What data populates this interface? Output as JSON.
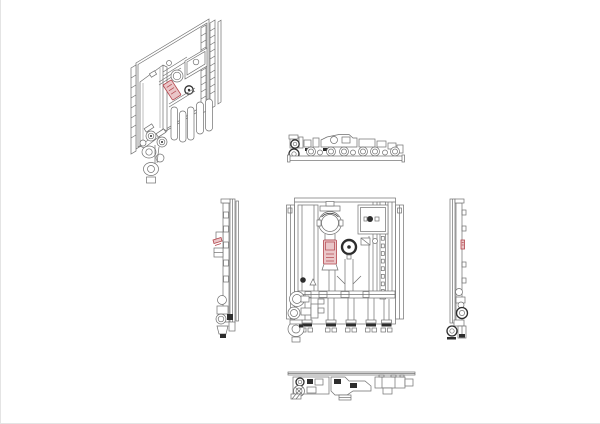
{
  "page": {
    "background": "#ffffff",
    "edge_line_color": "#e4e4e4"
  },
  "drawing": {
    "type": "cad-multiview-orthographic",
    "subject": "wall-mounted-hydraulic-module",
    "colors": {
      "line": "#6f6f6f",
      "line_dark": "#2d2d2d",
      "accent_stroke": "#b2444b",
      "accent_fill": "#eac6c8"
    },
    "views": [
      {
        "name": "isometric-view",
        "highlighted_part": "pump-red-label"
      },
      {
        "name": "top-view",
        "highlighted_part": null
      },
      {
        "name": "left-side-view",
        "highlighted_part": "pump-red-label"
      },
      {
        "name": "front-view",
        "highlighted_part": "pump-red-label"
      },
      {
        "name": "right-side-view",
        "highlighted_part": "pump-red-label"
      },
      {
        "name": "bottom-view",
        "highlighted_part": null
      }
    ]
  }
}
